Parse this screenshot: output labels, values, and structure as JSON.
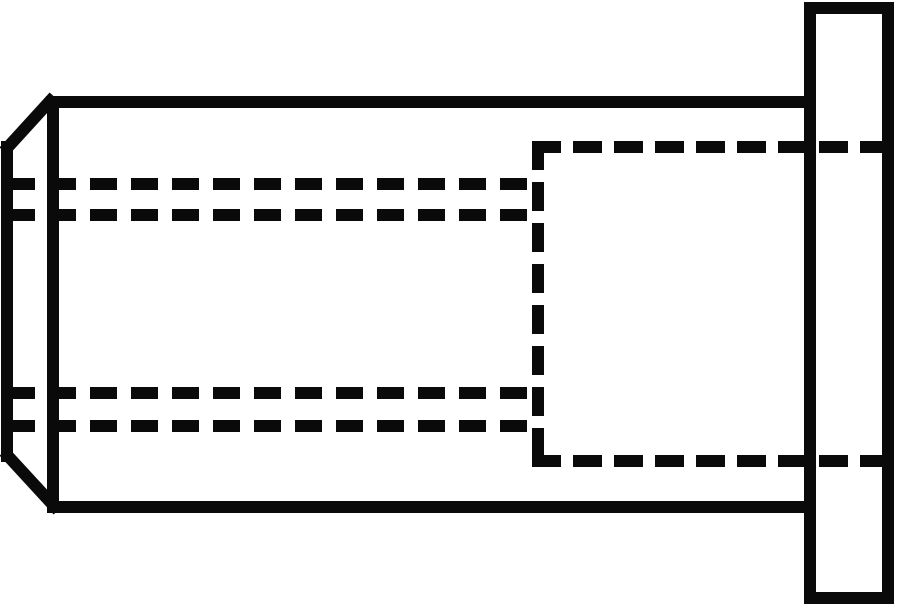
{
  "drawing": {
    "description": "Blind rivet nut with flat flange head, side elevation line drawing",
    "canvas": {
      "width": 900,
      "height": 609,
      "background": "#ffffff"
    },
    "stroke": {
      "color": "#0a0a0a",
      "width": 12
    },
    "shapes": [
      {
        "name": "body-top-edge",
        "type": "line",
        "x1": 46,
        "y1": 102,
        "x2": 812,
        "y2": 102,
        "cap": "butt"
      },
      {
        "name": "body-bottom-edge",
        "type": "line",
        "x1": 49,
        "y1": 507,
        "x2": 812,
        "y2": 507,
        "cap": "butt"
      },
      {
        "name": "closed-end-junction-edge",
        "type": "line",
        "x1": 53,
        "y1": 96,
        "x2": 53,
        "y2": 513,
        "cap": "butt"
      },
      {
        "name": "closed-end-chamfer-top-edge",
        "type": "line",
        "x1": 50,
        "y1": 101,
        "x2": 8,
        "y2": 147,
        "cap": "square"
      },
      {
        "name": "closed-end-face-edge",
        "type": "line",
        "x1": 7,
        "y1": 141,
        "x2": 7,
        "y2": 462,
        "cap": "butt"
      },
      {
        "name": "closed-end-chamfer-bottom-edge",
        "type": "line",
        "x1": 8,
        "y1": 456,
        "x2": 54,
        "y2": 506,
        "cap": "square"
      },
      {
        "name": "flange-outline",
        "type": "rect",
        "x": 810,
        "y": 8,
        "width": 78,
        "height": 590
      },
      {
        "name": "bore-thread-outer-top-hidden-line",
        "type": "line",
        "x1": 8,
        "y1": 184,
        "x2": 527,
        "y2": 184,
        "dash": [
          27,
          14
        ]
      },
      {
        "name": "bore-thread-inner-top-hidden-line",
        "type": "line",
        "x1": 8,
        "y1": 215,
        "x2": 527,
        "y2": 215,
        "dash": [
          27,
          14
        ]
      },
      {
        "name": "bore-thread-inner-bottom-hidden-line",
        "type": "line",
        "x1": 8,
        "y1": 393,
        "x2": 527,
        "y2": 393,
        "dash": [
          27,
          14
        ]
      },
      {
        "name": "bore-thread-outer-bottom-hidden-line",
        "type": "line",
        "x1": 8,
        "y1": 426,
        "x2": 527,
        "y2": 426,
        "dash": [
          27,
          14
        ]
      },
      {
        "name": "counterbore-top-hidden-line",
        "type": "line",
        "x1": 532,
        "y1": 147,
        "x2": 893,
        "y2": 147,
        "dash": [
          29,
          12
        ]
      },
      {
        "name": "counterbore-bottom-hidden-line",
        "type": "line",
        "x1": 532,
        "y1": 461,
        "x2": 893,
        "y2": 461,
        "dash": [
          29,
          12
        ]
      },
      {
        "name": "counterbore-left-hidden-line",
        "type": "line",
        "x1": 538,
        "y1": 141,
        "x2": 538,
        "y2": 467,
        "dash": [
          29,
          12
        ]
      }
    ]
  }
}
